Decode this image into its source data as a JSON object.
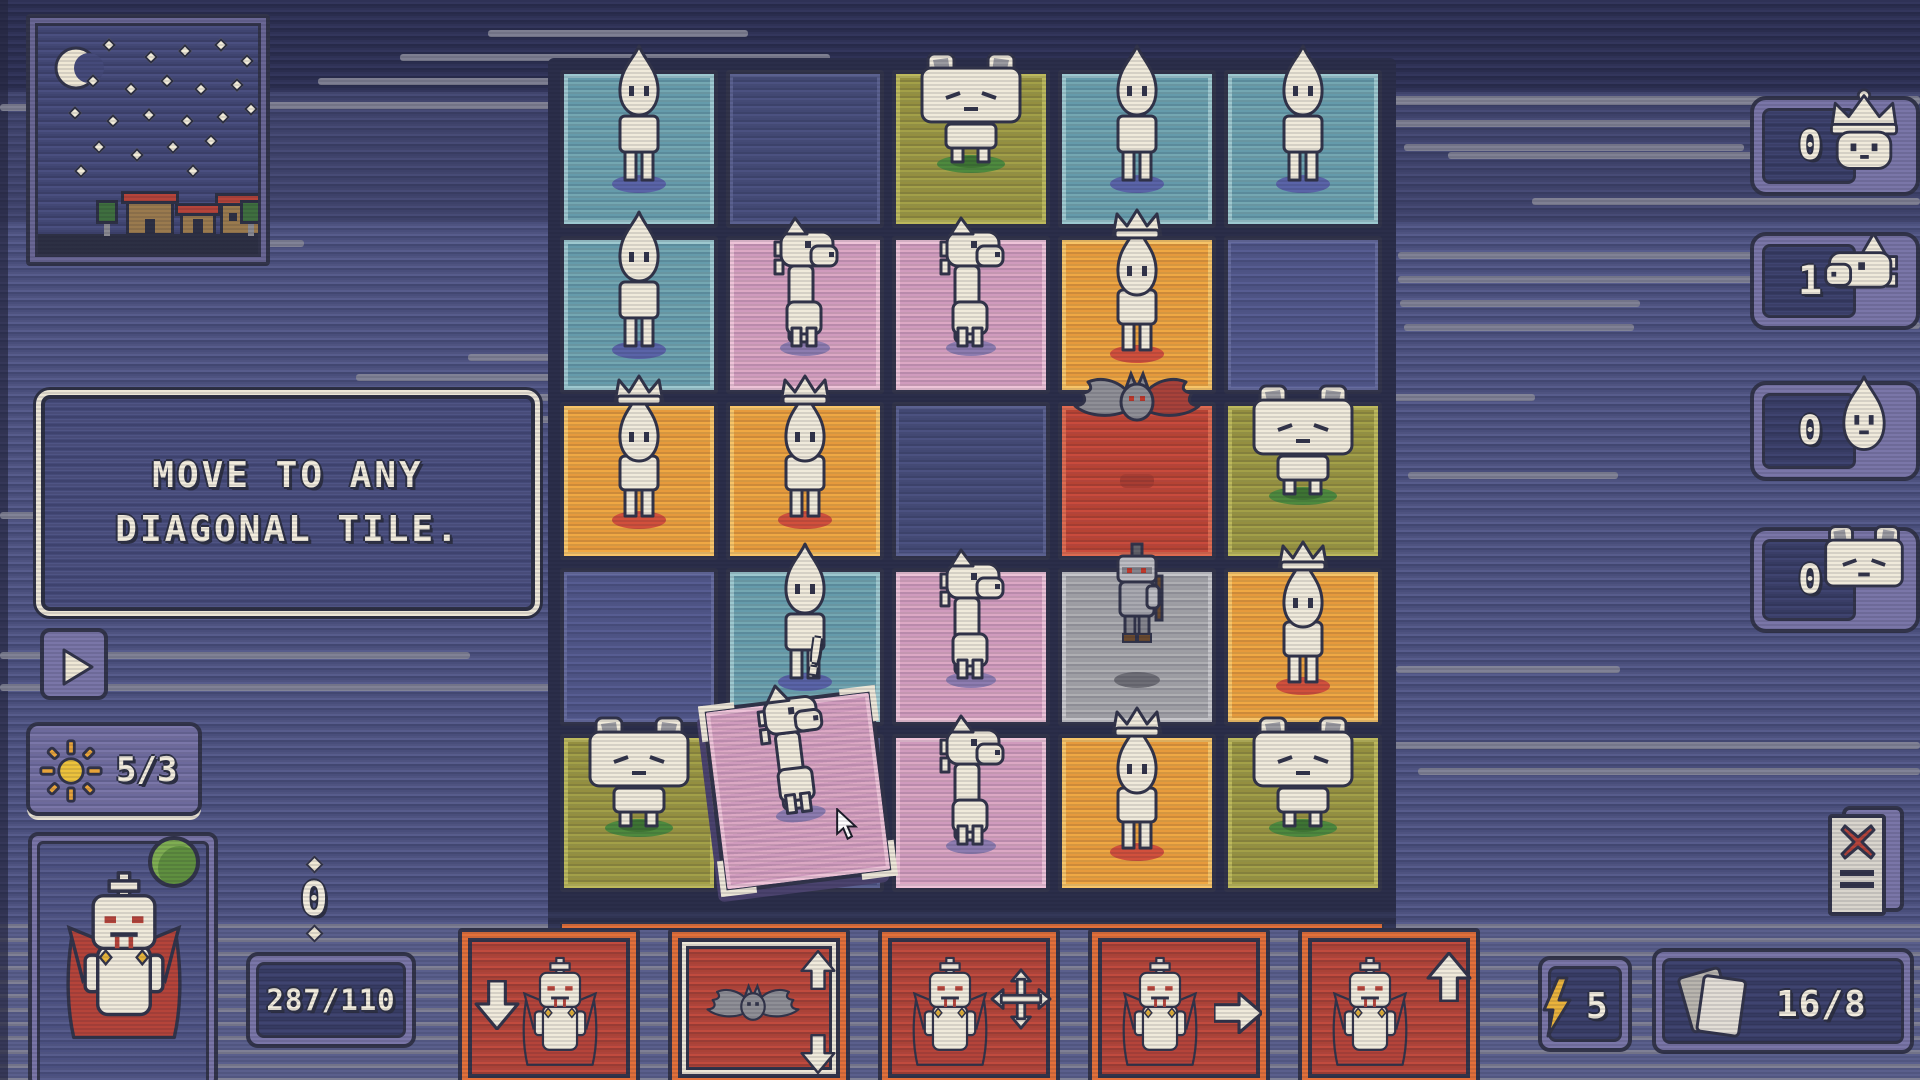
{
  "tooltip": {
    "line1": "MOVE TO ANY",
    "line2": "DIAGONAL TILE."
  },
  "hud": {
    "sun_counter": "5/3",
    "coin_count": "0",
    "health": "287/110",
    "energy_count": "5",
    "deck_count": "16/8",
    "alert_marker": "!"
  },
  "side_counters": [
    {
      "icon": "queen-icon",
      "value": "0"
    },
    {
      "icon": "knight-icon",
      "value": "1"
    },
    {
      "icon": "pawn-icon",
      "value": "0"
    },
    {
      "icon": "cat-icon",
      "value": "0"
    }
  ],
  "board": {
    "rows": 5,
    "cols": 5,
    "tiles": [
      {
        "row": 1,
        "col": 1,
        "color": "teal",
        "piece": "pawn"
      },
      {
        "row": 1,
        "col": 2,
        "color": "navy",
        "piece": null
      },
      {
        "row": 1,
        "col": 3,
        "color": "olive",
        "piece": "cat"
      },
      {
        "row": 1,
        "col": 4,
        "color": "teal",
        "piece": "pawn"
      },
      {
        "row": 1,
        "col": 5,
        "color": "teal",
        "piece": "pawn"
      },
      {
        "row": 2,
        "col": 1,
        "color": "teal",
        "piece": "pawn"
      },
      {
        "row": 2,
        "col": 2,
        "color": "pink",
        "piece": "knight"
      },
      {
        "row": 2,
        "col": 3,
        "color": "pink",
        "piece": "knight"
      },
      {
        "row": 2,
        "col": 4,
        "color": "orange",
        "piece": "crownpawn"
      },
      {
        "row": 2,
        "col": 5,
        "color": "indigo",
        "piece": null
      },
      {
        "row": 3,
        "col": 1,
        "color": "orange",
        "piece": "crownpawn"
      },
      {
        "row": 3,
        "col": 2,
        "color": "orange",
        "piece": "crownpawn"
      },
      {
        "row": 3,
        "col": 3,
        "color": "navy",
        "piece": null
      },
      {
        "row": 3,
        "col": 4,
        "color": "red",
        "piece": "bat"
      },
      {
        "row": 3,
        "col": 5,
        "color": "olive",
        "piece": "cat"
      },
      {
        "row": 4,
        "col": 1,
        "color": "indigo",
        "piece": null
      },
      {
        "row": 4,
        "col": 2,
        "color": "teal",
        "piece": "pawn"
      },
      {
        "row": 4,
        "col": 3,
        "color": "pink",
        "piece": "knight"
      },
      {
        "row": 4,
        "col": 4,
        "color": "gray",
        "piece": "enemy"
      },
      {
        "row": 4,
        "col": 5,
        "color": "orange",
        "piece": "crownpawn"
      },
      {
        "row": 5,
        "col": 1,
        "color": "olive",
        "piece": "cat"
      },
      {
        "row": 5,
        "col": 2,
        "color": "navy",
        "piece": null
      },
      {
        "row": 5,
        "col": 3,
        "color": "pink",
        "piece": "knight"
      },
      {
        "row": 5,
        "col": 4,
        "color": "orange",
        "piece": "crownpawn"
      },
      {
        "row": 5,
        "col": 5,
        "color": "olive",
        "piece": "cat"
      }
    ],
    "drag_tile": {
      "row": 5,
      "col": 2,
      "color": "pink",
      "piece": "knight",
      "state": "selected"
    }
  },
  "cards": [
    {
      "label": "move-down",
      "piece": "vampire",
      "arrows": [
        "down"
      ],
      "upgraded": false
    },
    {
      "label": "bat-shift",
      "piece": "bat",
      "arrows": [
        "up",
        "down"
      ],
      "upgraded": true
    },
    {
      "label": "move-any-direction",
      "piece": "vampire",
      "arrows": [
        "all"
      ],
      "upgraded": false
    },
    {
      "label": "move-right",
      "piece": "vampire",
      "arrows": [
        "right"
      ],
      "upgraded": false
    },
    {
      "label": "move-up",
      "piece": "vampire",
      "arrows": [
        "up"
      ],
      "upgraded": false
    }
  ],
  "colors": {
    "accent_orange": "#e2703a",
    "card_red": "#bf4839",
    "cream": "#f0eadb",
    "outline": "#32344a",
    "tile_teal": "#74a7b2",
    "tile_pink": "#dca8c4",
    "tile_orange": "#f0a843",
    "tile_olive": "#a3a048",
    "tile_red": "#c94b3c",
    "tile_gray": "#aeaeb2",
    "tile_navy": "#4b5180",
    "tile_indigo": "#575d92",
    "panel_purple": "#7a76a8",
    "gold": "#e8b53a",
    "vampire_red": "#b5443a",
    "orb_green": "#5f8f3f"
  }
}
